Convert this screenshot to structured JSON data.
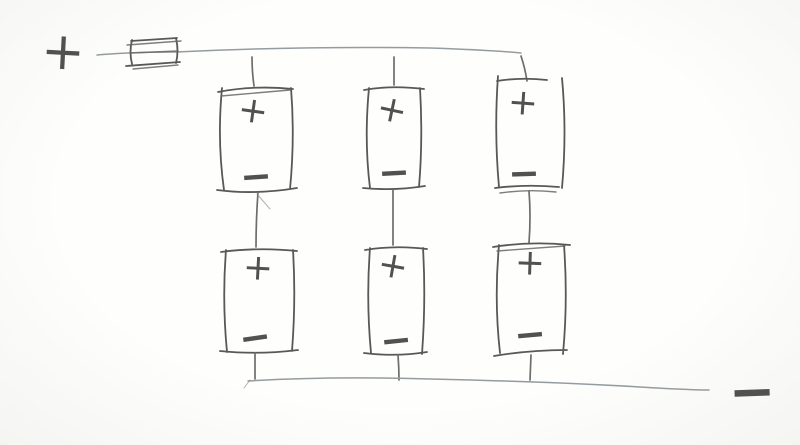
{
  "page": {
    "paper_color": "#fcfcfa",
    "component_ink_color": "#585858",
    "bus_wire_color": "#959ca0",
    "lead_wire_color": "#6d6d6d"
  },
  "schematic": {
    "kind": "hand-drawn battery circuit sketch",
    "positive_terminal": {
      "label": "+"
    },
    "negative_terminal": {
      "label": "−"
    },
    "fuse": {
      "symbol": "fuse"
    },
    "batteries": [
      {
        "id": "cell-top-left",
        "plus": "+",
        "minus": "−"
      },
      {
        "id": "cell-top-middle",
        "plus": "+",
        "minus": "−"
      },
      {
        "id": "cell-top-right",
        "plus": "+",
        "minus": "−"
      },
      {
        "id": "cell-bottom-left",
        "plus": "+",
        "minus": "−"
      },
      {
        "id": "cell-bottom-middle",
        "plus": "+",
        "minus": "−"
      },
      {
        "id": "cell-bottom-right",
        "plus": "+",
        "minus": "−"
      }
    ]
  }
}
